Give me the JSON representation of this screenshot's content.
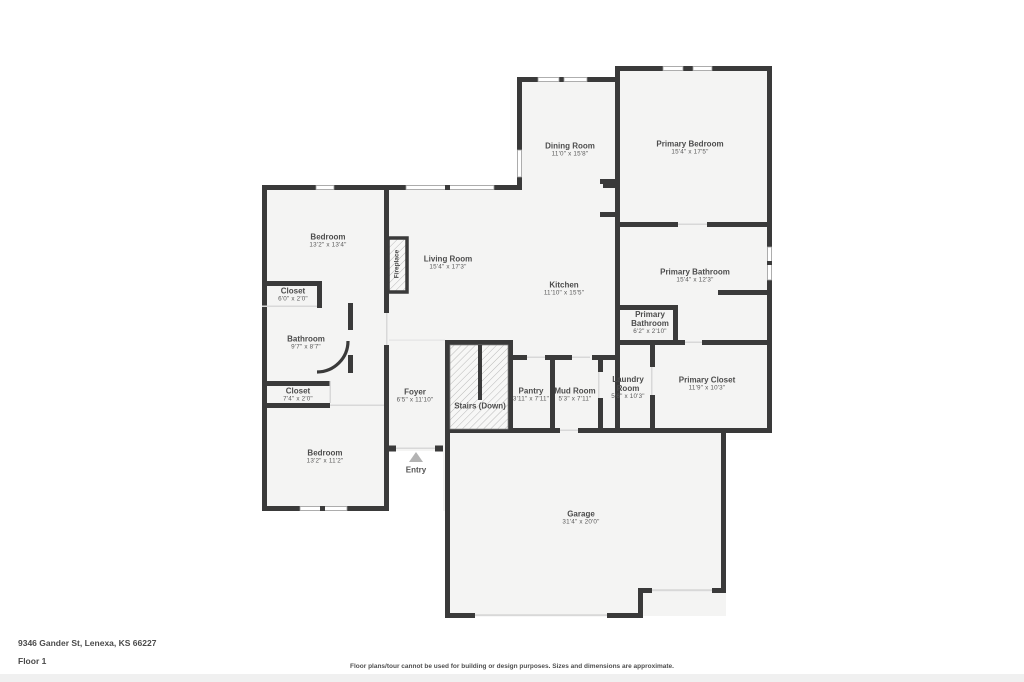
{
  "address": "9346 Gander St, Lenexa, KS 66227",
  "floor_label": "Floor 1",
  "disclaimer": "Floor plans/tour cannot be used for building or design purposes. Sizes and dimensions are approximate.",
  "colors": {
    "wall": "#3a3a3a",
    "floor_fill": "#f4f4f3",
    "text": "#4c4c4c",
    "background": "#ffffff"
  },
  "rooms": [
    {
      "name": "Bedroom",
      "dims": "13'2\" x 13'4\""
    },
    {
      "name": "Closet",
      "dims": "6'0\" x 2'0\""
    },
    {
      "name": "Bathroom",
      "dims": "9'7\" x 8'7\""
    },
    {
      "name": "Closet",
      "dims": "7'4\" x 2'0\""
    },
    {
      "name": "Bedroom",
      "dims": "13'2\" x 11'2\""
    },
    {
      "name": "Living Room",
      "dims": "15'4\" x 17'3\""
    },
    {
      "name": "Dining Room",
      "dims": "11'0\" x 15'8\""
    },
    {
      "name": "Primary Bedroom",
      "dims": "15'4\" x 17'5\""
    },
    {
      "name": "Kitchen",
      "dims": "11'10\" x 15'5\""
    },
    {
      "name": "Primary Bathroom",
      "dims": "15'4\" x 12'3\""
    },
    {
      "name": "Primary Bathroom",
      "dims": "6'2\" x 2'10\""
    },
    {
      "name": "Foyer",
      "dims": "6'5\" x 11'10\""
    },
    {
      "name": "Pantry",
      "dims": "3'11\" x 7'11\""
    },
    {
      "name": "Mud Room",
      "dims": "5'3\" x 7'11\""
    },
    {
      "name": "Laundry Room",
      "dims": "5'6\" x 10'3\""
    },
    {
      "name": "Primary Closet",
      "dims": "11'9\" x 10'3\""
    },
    {
      "name": "Garage",
      "dims": "31'4\" x 20'0\""
    }
  ],
  "annotations": {
    "fireplace": "Fireplace",
    "stairs": "Stairs (Down)",
    "entry": "Entry"
  }
}
